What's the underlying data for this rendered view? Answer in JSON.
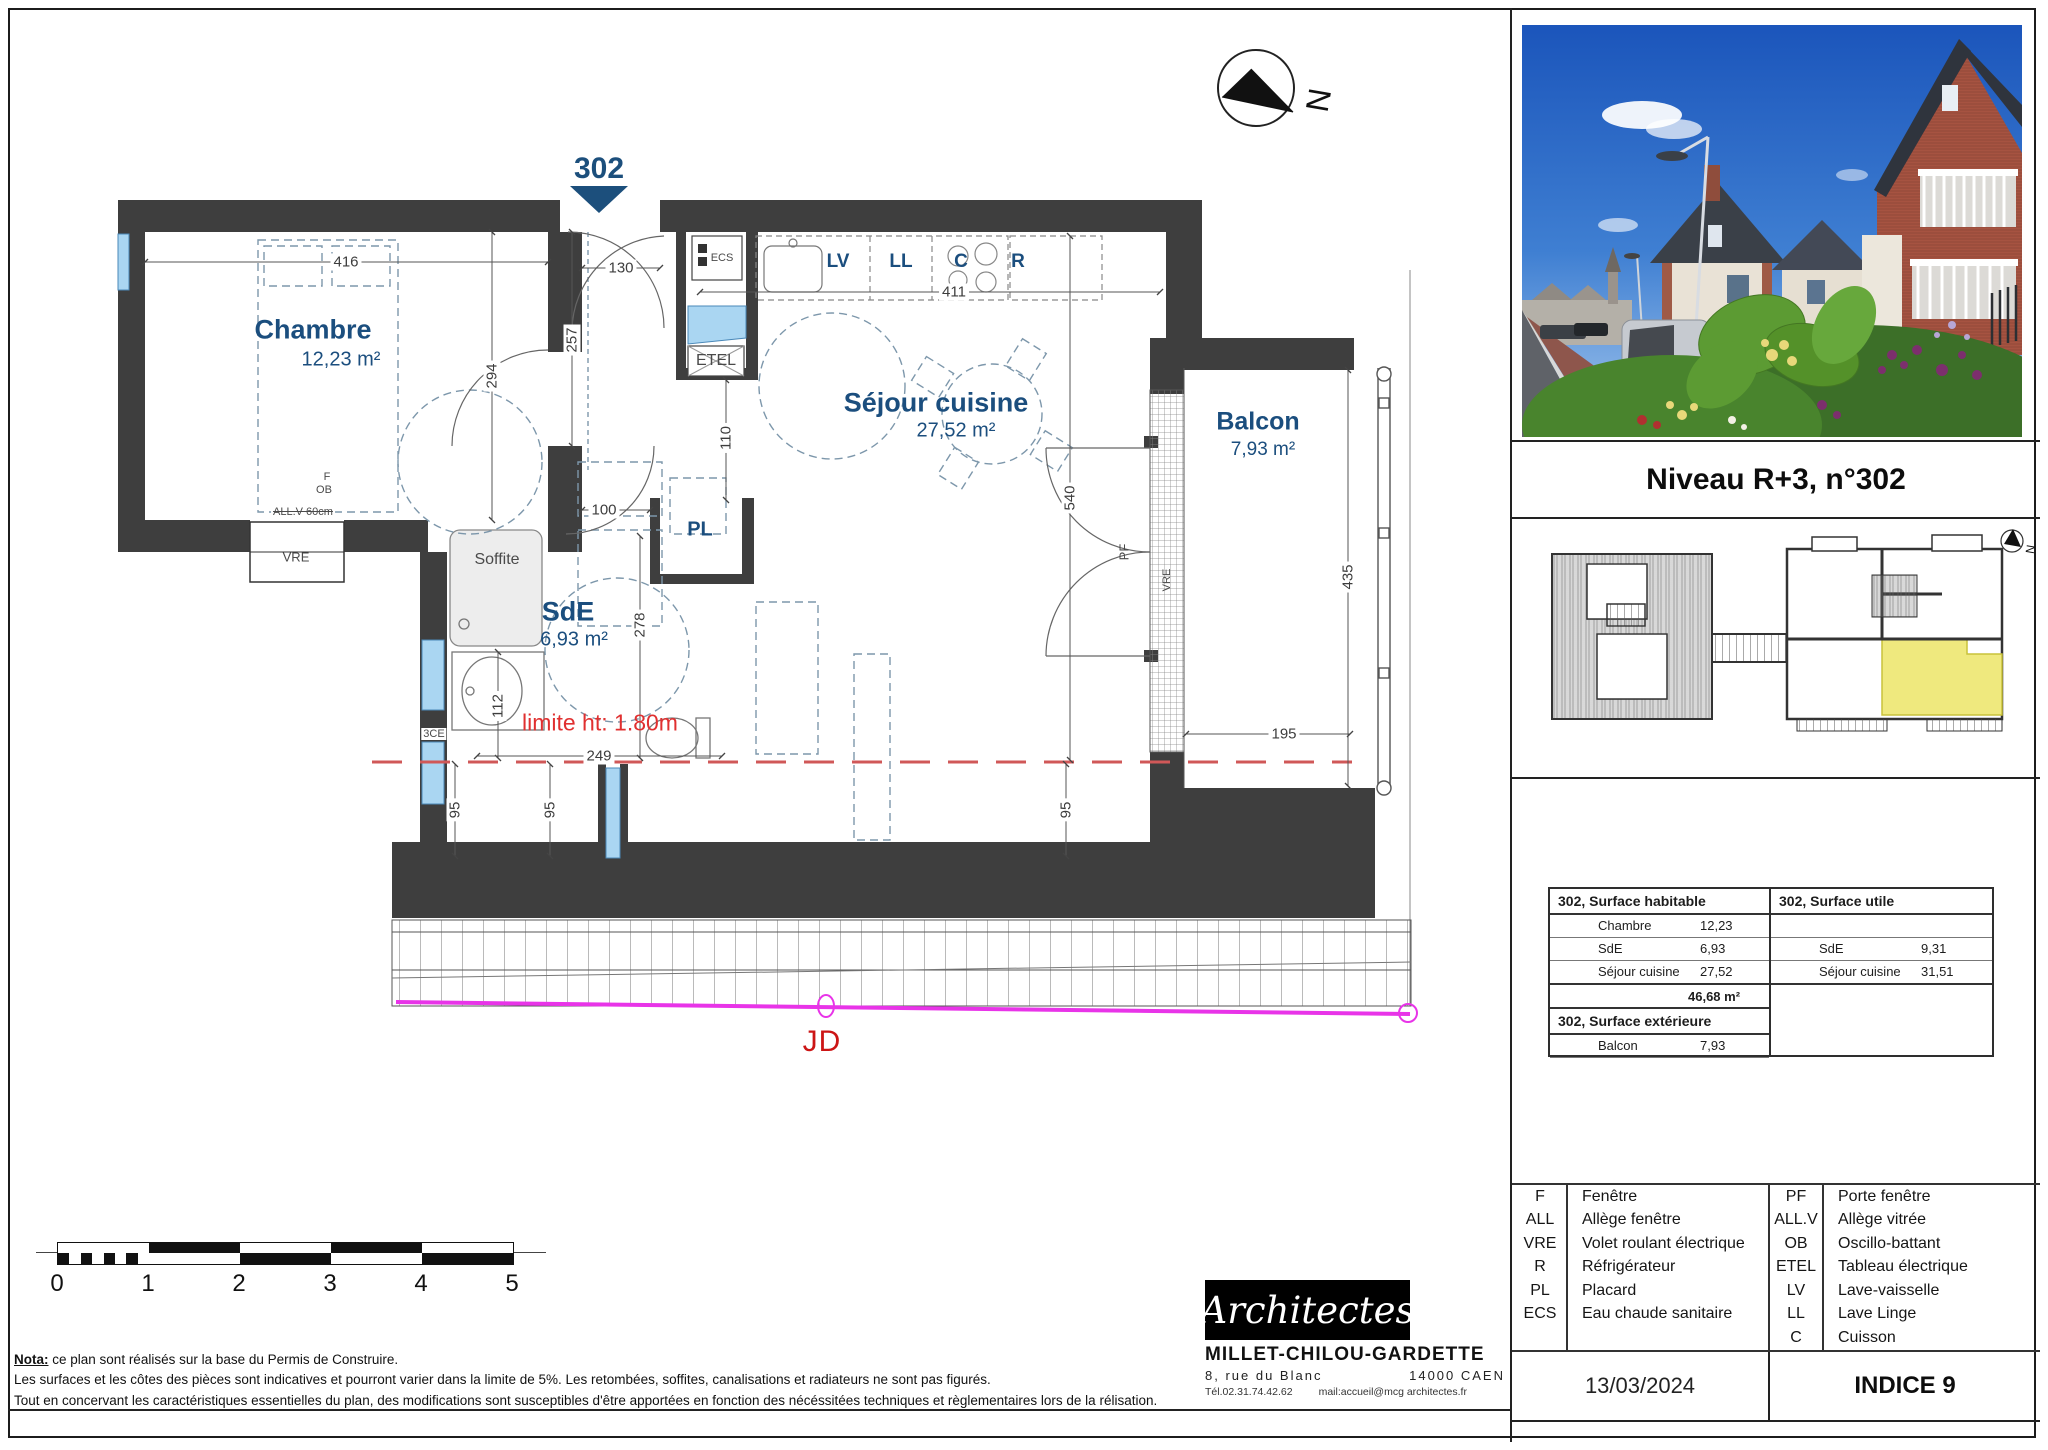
{
  "titleblock": {
    "title": "Niveau R+3, n°302",
    "date": "13/03/2024",
    "indice": "INDICE 9"
  },
  "colors": {
    "wall": "#3e3e3e",
    "room_label": "#1b4e7e",
    "unit_highlight": "#efe97e",
    "limit_red": "#e03030",
    "joint_magenta": "#e834e8",
    "window_blue": "#aad6f2"
  },
  "plan": {
    "apt_marker": "302",
    "north": "N",
    "rooms": [
      {
        "name": "Chambre",
        "area": "12,23 m²",
        "nx": 313,
        "ny": 330,
        "ns": 27,
        "ax": 341,
        "ay": 360,
        "as": 20
      },
      {
        "name": "Séjour cuisine",
        "area": "27,52 m²",
        "nx": 936,
        "ny": 403,
        "ns": 27,
        "ax": 956,
        "ay": 431,
        "as": 20
      },
      {
        "name": "SdE",
        "area": "6,93 m²",
        "nx": 568,
        "ny": 612,
        "ns": 27,
        "ax": 574,
        "ay": 640,
        "as": 20
      },
      {
        "name": "Balcon",
        "area": "7,93 m²",
        "nx": 1258,
        "ny": 422,
        "ns": 25,
        "ax": 1263,
        "ay": 450,
        "as": 19
      }
    ],
    "labels": [
      {
        "t": "ECS",
        "x": 722,
        "y": 258,
        "s": 11
      },
      {
        "t": "ETEL",
        "x": 716,
        "y": 361,
        "s": 16
      },
      {
        "t": "PL",
        "x": 700,
        "y": 530,
        "s": 20,
        "c": "blue"
      },
      {
        "t": "Soffite",
        "x": 497,
        "y": 560,
        "s": 16
      },
      {
        "t": "VRE",
        "x": 296,
        "y": 557,
        "s": 13
      },
      {
        "t": "ALL.V 60cm",
        "x": 303,
        "y": 512,
        "s": 11,
        "c": "strike bgw"
      },
      {
        "t": "F",
        "x": 327,
        "y": 477,
        "s": 11
      },
      {
        "t": "OB",
        "x": 324,
        "y": 490,
        "s": 11
      },
      {
        "t": "3CE",
        "x": 434,
        "y": 734,
        "s": 11,
        "c": "bgw"
      },
      {
        "t": "PF",
        "x": 1124,
        "y": 552,
        "s": 13,
        "r": 1
      },
      {
        "t": "VRE",
        "x": 1167,
        "y": 580,
        "s": 11,
        "r": 1
      },
      {
        "t": "LV",
        "x": 838,
        "y": 262,
        "s": 19,
        "c": "blue"
      },
      {
        "t": "LL",
        "x": 901,
        "y": 262,
        "s": 19,
        "c": "blue"
      },
      {
        "t": "C",
        "x": 961,
        "y": 262,
        "s": 19,
        "c": "blue"
      },
      {
        "t": "R",
        "x": 1018,
        "y": 262,
        "s": 19,
        "c": "blue"
      }
    ],
    "dimensions": [
      {
        "t": "416",
        "x": 346,
        "y": 262
      },
      {
        "t": "130",
        "x": 621,
        "y": 268
      },
      {
        "t": "294",
        "x": 492,
        "y": 376,
        "r": 1
      },
      {
        "t": "257",
        "x": 572,
        "y": 340,
        "r": 1
      },
      {
        "t": "110",
        "x": 726,
        "y": 438,
        "r": 1
      },
      {
        "t": "100",
        "x": 604,
        "y": 510
      },
      {
        "t": "278",
        "x": 640,
        "y": 625,
        "r": 1
      },
      {
        "t": "112",
        "x": 498,
        "y": 706,
        "r": 1
      },
      {
        "t": "249",
        "x": 599,
        "y": 756
      },
      {
        "t": "411",
        "x": 954,
        "y": 292
      },
      {
        "t": "540",
        "x": 1070,
        "y": 498,
        "r": 1
      },
      {
        "t": "435",
        "x": 1348,
        "y": 577,
        "r": 1
      },
      {
        "t": "195",
        "x": 1284,
        "y": 734
      },
      {
        "t": "95",
        "x": 455,
        "y": 810,
        "r": 1
      },
      {
        "t": "95",
        "x": 550,
        "y": 810,
        "r": 1
      },
      {
        "t": "95",
        "x": 1066,
        "y": 810,
        "r": 1
      }
    ],
    "annotations": {
      "limite": "limite ht: 1.80m",
      "jd": "JD"
    }
  },
  "scalebar": {
    "labels": [
      "0",
      "1",
      "2",
      "3",
      "4",
      "5"
    ]
  },
  "nota": {
    "label": "Nota:",
    "line1": "ce plan sont réalisés sur la base du Permis de Construire.",
    "line2": "Les surfaces et les côtes des pièces sont indicatives et pourront varier dans la limite de 5%. Les retombées, soffites, canalisations et radiateurs ne sont pas figurés.",
    "line3": "Tout en concervant les caractéristiques essentielles du plan, des modifications sont susceptibles d'être apportées en fonction des nécéssitées techniques et règlementaires  lors de la rélisation."
  },
  "architect": {
    "script": "Architectes",
    "name": "MILLET-CHILOU-GARDETTE",
    "addr1": "8, rue du Blanc",
    "city": "14000 CAEN",
    "tel": "Tél.02.31.74.42.62",
    "mail": "mail:accueil@mcg architectes.fr"
  },
  "surfaces": {
    "habitable": {
      "title": "302, Surface habitable",
      "rows": [
        [
          "Chambre",
          "12,23"
        ],
        [
          "SdE",
          "6,93"
        ],
        [
          "Séjour cuisine",
          "27,52"
        ]
      ],
      "total": "46,68 m²"
    },
    "exterieure": {
      "title": "302, Surface extérieure",
      "rows": [
        [
          "Balcon",
          "7,93"
        ]
      ]
    },
    "utile": {
      "title": "302, Surface utile",
      "rows": [
        [
          "SdE",
          "9,31"
        ],
        [
          "Séjour cuisine",
          "31,51"
        ]
      ]
    }
  },
  "legend": {
    "left": [
      [
        "F",
        "Fenêtre"
      ],
      [
        "ALL",
        "Allège fenêtre"
      ],
      [
        "VRE",
        "Volet roulant électrique"
      ],
      [
        "R",
        "Réfrigérateur"
      ],
      [
        "PL",
        "Placard"
      ],
      [
        "ECS",
        "Eau chaude sanitaire"
      ]
    ],
    "right": [
      [
        "PF",
        "Porte fenêtre"
      ],
      [
        "ALL.V",
        "Allège vitrée"
      ],
      [
        "OB",
        "Oscillo-battant"
      ],
      [
        "ETEL",
        "Tableau électrique"
      ],
      [
        "LV",
        "Lave-vaisselle"
      ],
      [
        "LL",
        "Lave Linge"
      ],
      [
        "C",
        "Cuisson"
      ]
    ]
  }
}
